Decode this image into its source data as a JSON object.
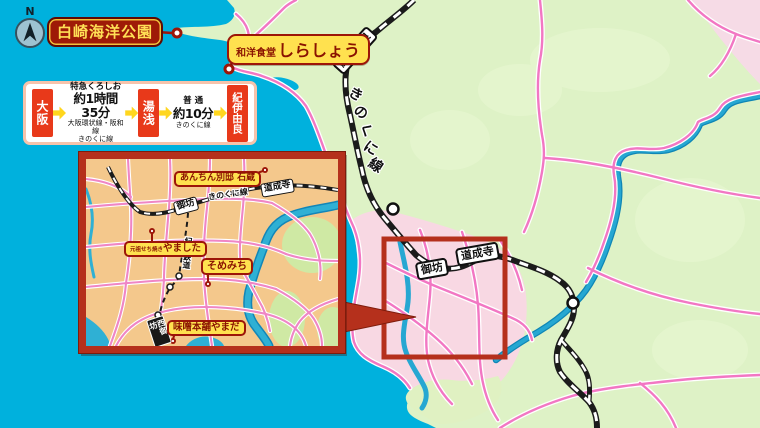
{
  "compass": {
    "north_label": "N"
  },
  "map_labels": {
    "park": "白崎海洋公園",
    "restaurant_prefix": "和洋食堂",
    "restaurant_name": "しらしょう"
  },
  "route_box": {
    "origin": "大阪",
    "mid": "湯浅",
    "dest": "紀伊由良",
    "leg1": {
      "train": "特急くろしお",
      "time": "約1時間35分",
      "lines1": "大阪環状線・阪和線",
      "lines2": "きのくに線"
    },
    "leg2": {
      "train": "普 通",
      "time": "約10分",
      "lines1": "きのくに線"
    }
  },
  "main_map": {
    "line_chars": [
      "き",
      "の",
      "く",
      "に",
      "線"
    ],
    "station_kiiyura": "紀伊由良",
    "station_gobo": "御坊",
    "station_dojoji": "道成寺"
  },
  "inset": {
    "line_label": "きのくに線",
    "kishu_line": "紀州鉄道",
    "station_gobo": "御坊",
    "station_dojoji": "道成寺",
    "station_nishigobo": "西御坊",
    "poi_anchin": "あんちん別邸 石蔵",
    "poi_yamashita_prefix": "元祖せち焼き",
    "poi_yamashita": "やました",
    "poi_somemichi": "そめみち",
    "poi_miso": "味噌本舗やまだ"
  },
  "colors": {
    "sea": "#00b1dd",
    "land": "#def2c6",
    "urban": "#f8d8e3",
    "inset_ground": "#f4c88c",
    "road": "#f277c3",
    "river": "#26a7d2",
    "railway": "#1b1b1b",
    "accent_red": "#b5301c",
    "label_red": "#9c1508",
    "label_yellow": "#ffe14f",
    "route_red": "#e8391a",
    "arrow_yellow": "#ffd61e"
  }
}
